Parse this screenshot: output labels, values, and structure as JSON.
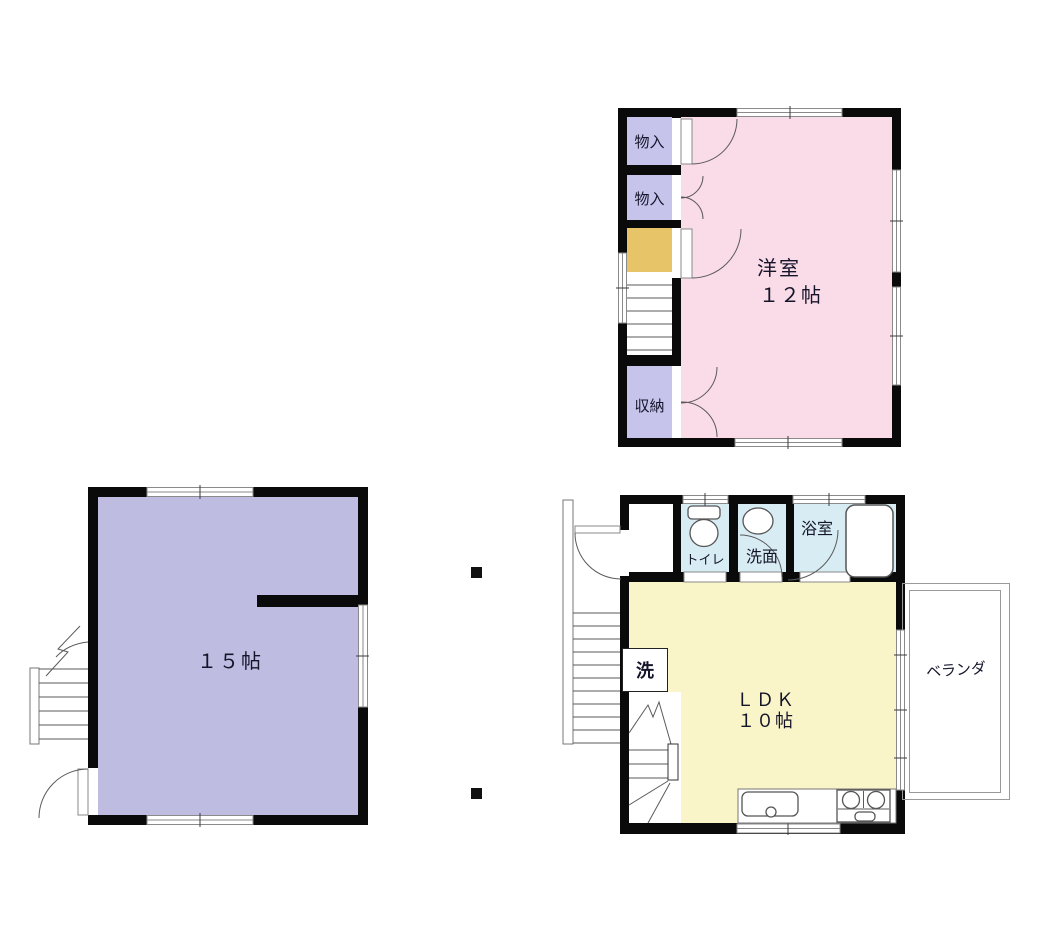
{
  "diagram_type": "floor-plan",
  "colors": {
    "wall": "#0a0a0a",
    "room_pink": "#fadbe8",
    "closet_lavender": "#c6c4eb",
    "room_lavender": "#bfbce1",
    "landing_tan": "#e8c468",
    "room_yellow": "#faf4c9",
    "sanitary_blue": "#d8ecf4",
    "line_gray": "#8a8a8a"
  },
  "plans": {
    "second_floor": {
      "closet1": "物入",
      "closet2": "物入",
      "storage": "収納",
      "room_name": "洋室",
      "room_size": "１２帖"
    },
    "first_floor_left": {
      "room_size": "１５帖"
    },
    "first_floor_right": {
      "toilet": "トイレ",
      "washroom": "洗面",
      "bathroom": "浴室",
      "laundry": "洗",
      "room_name": "ＬＤＫ",
      "room_size": "１０帖",
      "veranda": "ベランダ"
    }
  }
}
